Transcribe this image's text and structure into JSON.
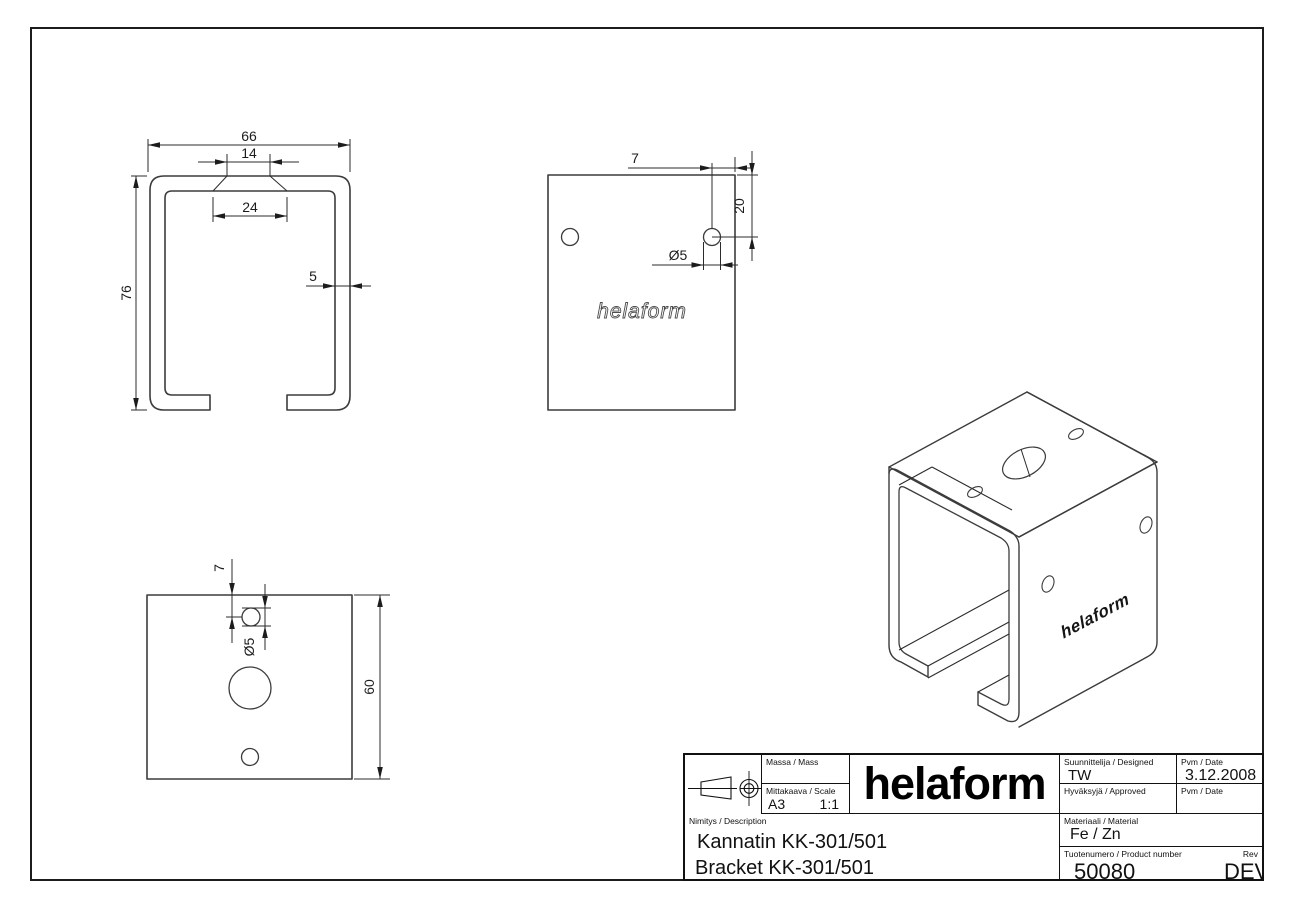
{
  "views": {
    "section": {
      "width": "66",
      "slot_top": "14",
      "slot_bottom": "24",
      "wall": "5",
      "height": "76"
    },
    "side": {
      "edge_dist": "7",
      "top_dist": "20",
      "hole_dia": "Ø5",
      "watermark": "helaform"
    },
    "top": {
      "edge_dist": "7",
      "hole_dia": "Ø5",
      "depth": "60"
    },
    "iso": {
      "brand": "helaform"
    }
  },
  "title_block": {
    "mass_label": "Massa / Mass",
    "mass_value": "",
    "scale_label": "Mittakaava / Scale",
    "sheet_size": "A3",
    "scale_value": "1:1",
    "logo": "helaform",
    "designed_label": "Suunnittelija / Designed",
    "designed_value": "TW",
    "date1_label": "Pvm / Date",
    "date1_value": "3.12.2008",
    "approved_label": "Hyväksyjä / Approved",
    "approved_value": "",
    "date2_label": "Pvm / Date",
    "date2_value": "",
    "description_label": "Nimitys / Description",
    "description_fi": "Kannatin KK-301/501",
    "description_en": "Bracket KK-301/501",
    "material_label": "Materiaali / Material",
    "material_value": "Fe / Zn",
    "product_label": "Tuotenumero / Product number",
    "product_value": "50080",
    "rev_label": "Rev",
    "rev_value": "DEV.003"
  }
}
